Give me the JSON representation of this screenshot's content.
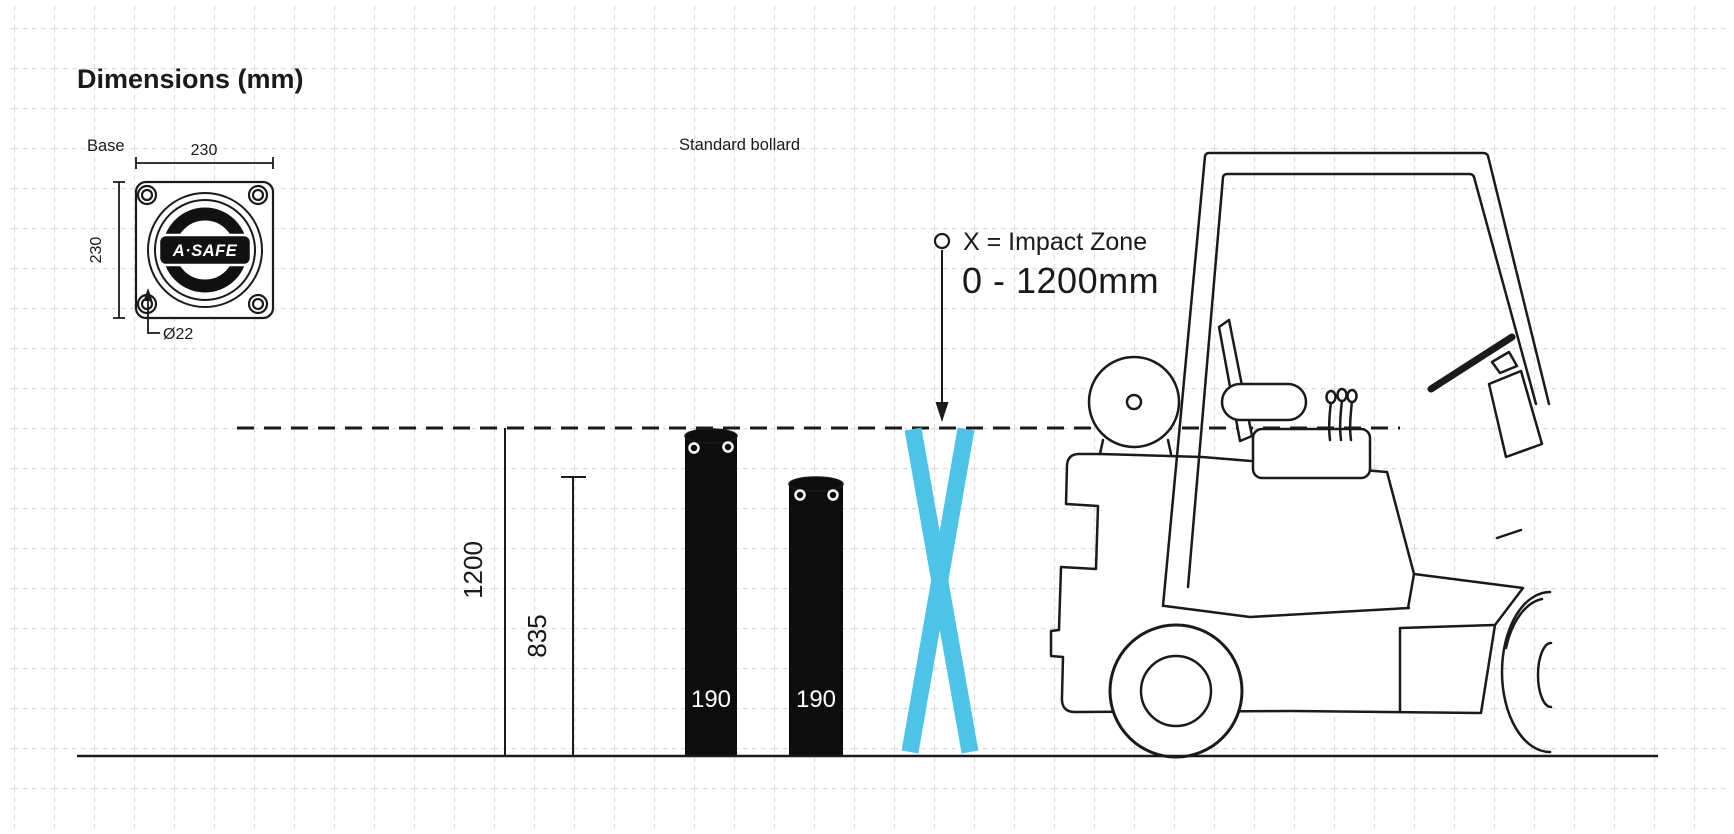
{
  "title": "Dimensions (mm)",
  "colors": {
    "impact_blue": "#4EC3E8",
    "line_black": "#1a1a1a",
    "bollard_black": "#0d0d0d",
    "grid_gray": "#dcdcdc",
    "background": "#ffffff"
  },
  "base_detail": {
    "label": "Base",
    "logo_text": "A·SAFE",
    "width_label": "230",
    "height_label": "230",
    "hole_diameter_label": "Ø22"
  },
  "bollards": {
    "section_label": "Standard bollard",
    "height_primary_label": "1200",
    "height_secondary_label": "835",
    "items": [
      {
        "diameter_label": "190"
      },
      {
        "diameter_label": "190"
      }
    ]
  },
  "impact_zone": {
    "legend_line1": "X = Impact Zone",
    "legend_line2": "0 - 1200mm"
  }
}
